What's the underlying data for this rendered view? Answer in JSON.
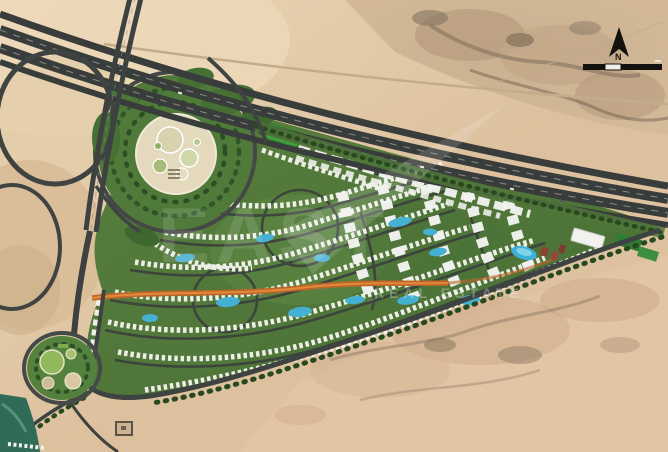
{
  "image": {
    "kind": "aerial-satellite-master-plan",
    "subject": "desert residential compound master plan beside highway interchange",
    "width_px": 668,
    "height_px": 452
  },
  "compass": {
    "north_label": "N"
  },
  "scale_bar": {
    "style": "black-and-white segmented bar",
    "segments": 3
  },
  "watermark": {
    "big_text": "EAST",
    "small_text": "REAL ESTATE"
  },
  "palette": {
    "sand_light": "#e8d4b4",
    "sand_mid": "#dcc09c",
    "rock_dark": "#8d7a66",
    "road_asphalt": "#3a3f3d",
    "site_green": "#55793c",
    "lawn_bright": "#3da23c",
    "villa_white": "#f4f4ef",
    "pool_blue": "#45b1d2",
    "spine_orange": "#c0662a",
    "tree_dark": "#28491f",
    "club_red": "#8c4434"
  },
  "features": {
    "highway": "multi-lane highway crossing diagonally",
    "interchange": "cloverleaf loop ramps top-left",
    "central_park": "large circular park with round gardens",
    "small_park": "round pocket park bottom-left",
    "villa_district": "curved rows of villas with pools",
    "apartment_district": "larger apartment blocks on east side",
    "commercial_strip": "linear retail buildings along highway",
    "orange_spine": "orange pedestrian spine through community",
    "desert": "open desert with rocky outcrops"
  }
}
